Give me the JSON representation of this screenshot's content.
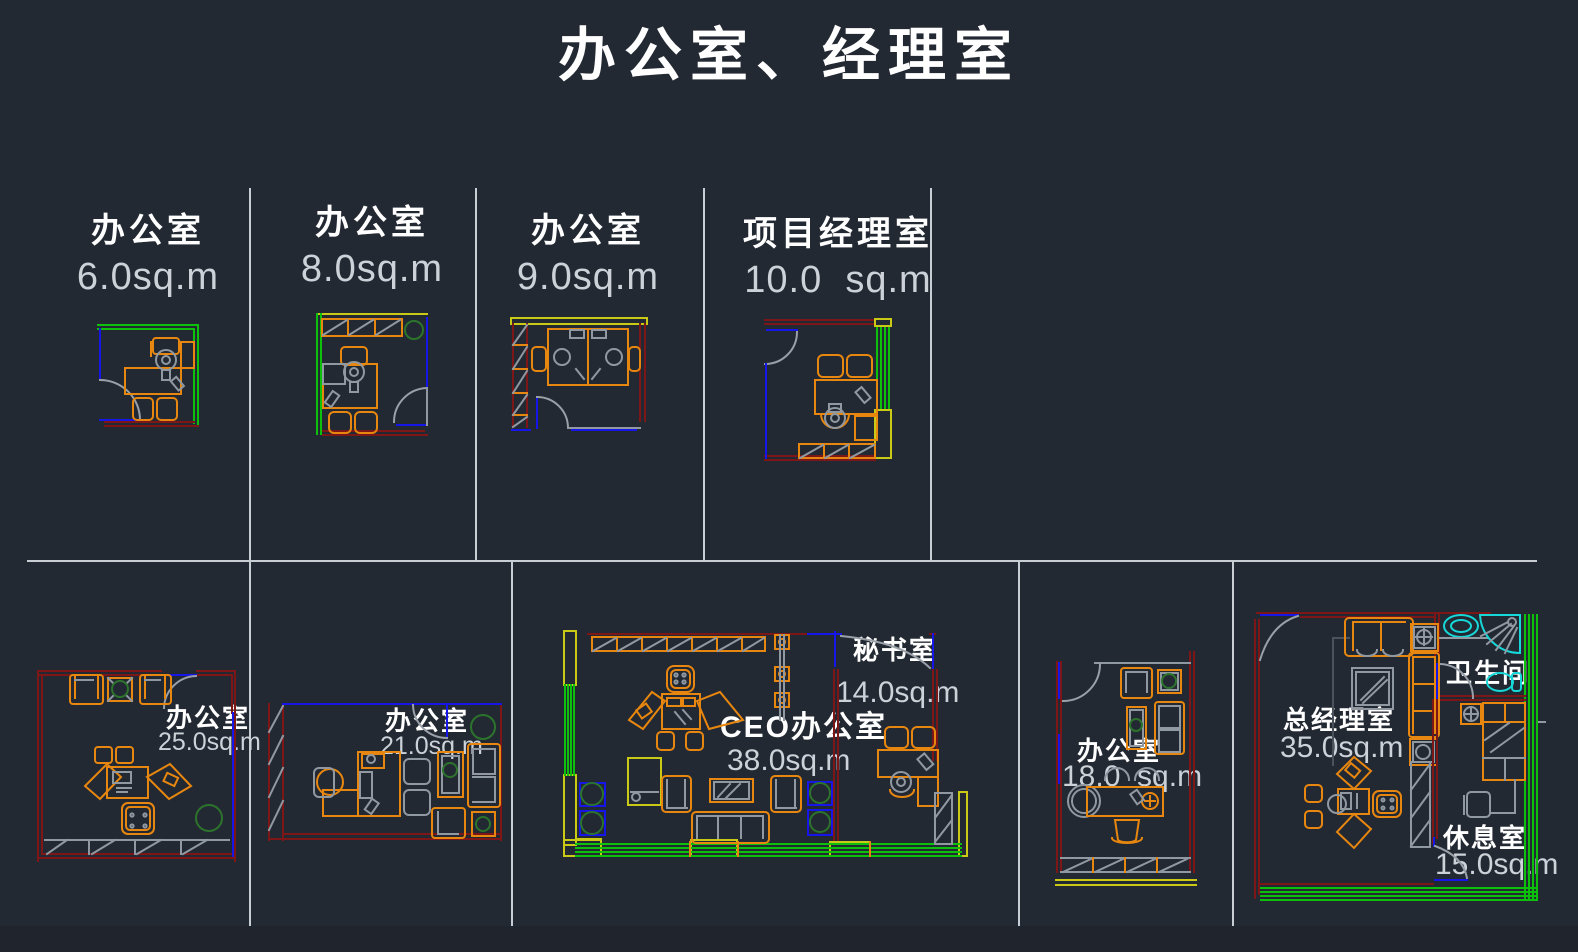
{
  "title": "办公室、经理室",
  "rooms": [
    {
      "id": "office-6",
      "name": "办公室",
      "area": "6.0sq.m"
    },
    {
      "id": "office-8",
      "name": "办公室",
      "area": "8.0sq.m"
    },
    {
      "id": "office-9",
      "name": "办公室",
      "area": "9.0sq.m"
    },
    {
      "id": "pm-office-10",
      "name": "项目经理室",
      "area": "10.0  sq.m"
    },
    {
      "id": "office-25",
      "name": "办公室",
      "area": "25.0sq.m"
    },
    {
      "id": "office-21",
      "name": "办公室",
      "area": "21.0sq.m"
    },
    {
      "id": "ceo-office-38",
      "name": "CEO办公室",
      "area": "38.0sq.m"
    },
    {
      "id": "secretary-14",
      "name": "秘书室",
      "area": "14.0sq.m"
    },
    {
      "id": "office-18",
      "name": "办公室",
      "area": "18.0  sq.m"
    },
    {
      "id": "gm-office-35",
      "name": "总经理室",
      "area": "35.0sq.m"
    },
    {
      "id": "bathroom",
      "name": "卫生间",
      "area": ""
    },
    {
      "id": "rest-room-15",
      "name": "休息室",
      "area": "15.0sq.m"
    }
  ],
  "colors": {
    "background": "#232933",
    "wall_green": "#0cc00c",
    "wall_blue": "#1616e8",
    "wall_dark_red": "#7d1616",
    "wall_yellow": "#c9c916",
    "furniture_orange": "#e8870f",
    "detail_gray": "#9099a2",
    "fixture_cyan": "#16d8d8",
    "plant_green": "#1e5c1e",
    "grid_divider": "#c9ced4",
    "text_white": "#ffffff",
    "text_gray": "#ccd2d8"
  }
}
